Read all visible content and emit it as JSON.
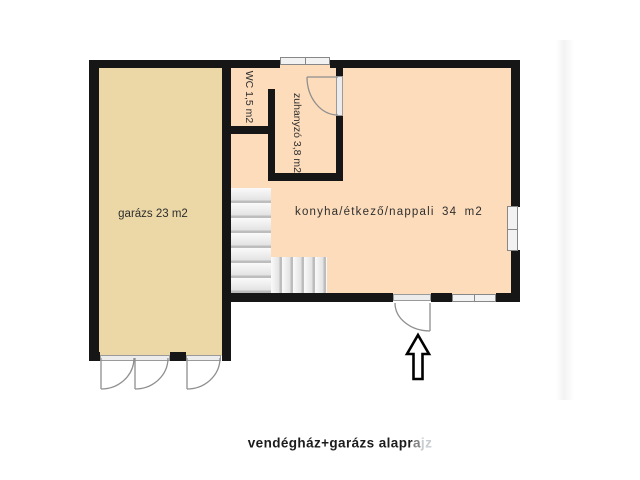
{
  "caption": {
    "part_main": "vendégház+garázs alapr",
    "part_fade1": "a",
    "part_fade2": "jz"
  },
  "rooms": {
    "garage": {
      "label": "garázs 23 m2"
    },
    "wc": {
      "label": "WC 1,5 m2"
    },
    "shower": {
      "label": "zuhanyzó 3,8 m2"
    },
    "living": {
      "label": "konyha/étkező/nappali 34 m2"
    }
  },
  "colors": {
    "wall": "#161616",
    "garage_fill": "#ecd8a7",
    "room_fill": "#fcdcbb",
    "window_fill": "#f2f2f2",
    "door_line": "#8f8f8f",
    "label_text": "#2e2e2e"
  }
}
